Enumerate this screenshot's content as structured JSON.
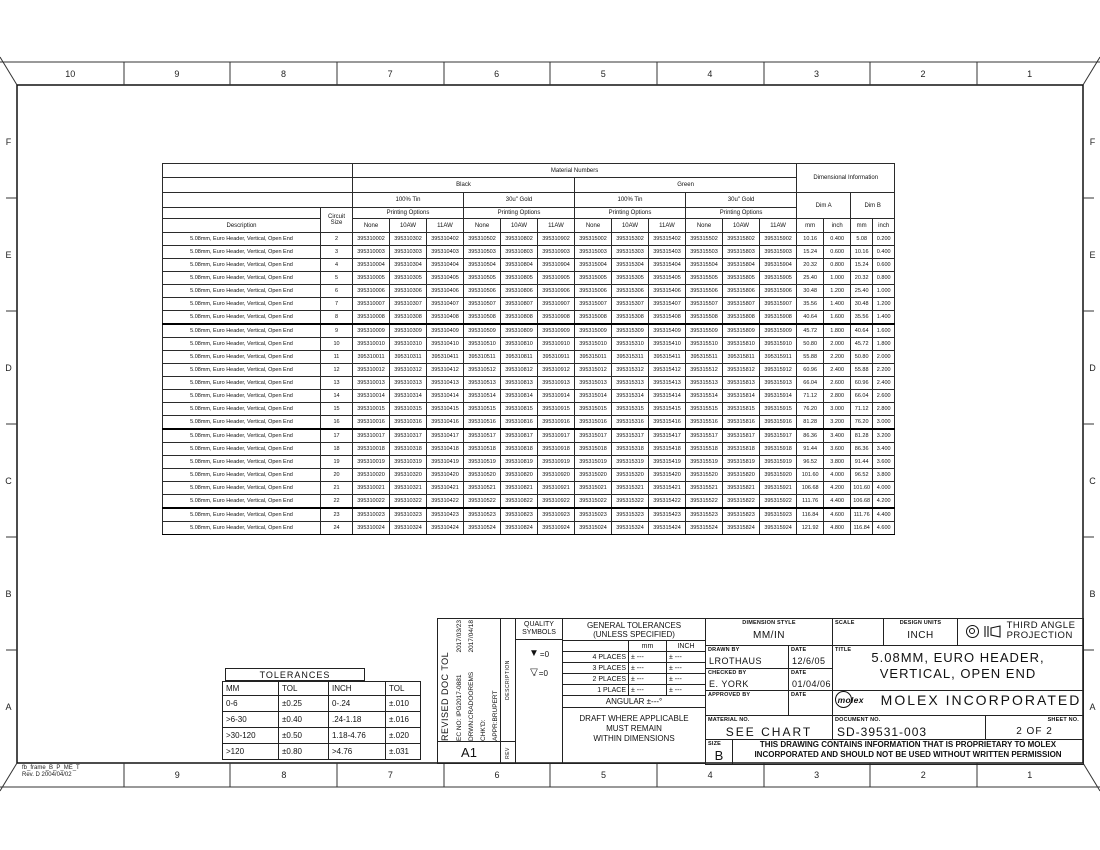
{
  "frame": {
    "top_zones": [
      "10",
      "9",
      "8",
      "7",
      "6",
      "5",
      "4",
      "3",
      "2",
      "1"
    ],
    "bottom_zones": [
      "9",
      "8",
      "7",
      "6",
      "5",
      "4",
      "3",
      "2",
      "1"
    ],
    "left_zones": [
      "F",
      "E",
      "D",
      "C",
      "B",
      "A"
    ],
    "right_zones": [
      "F",
      "E",
      "D",
      "C",
      "B",
      "A"
    ],
    "stamp_line1": "fb_frame_B_P_ME_T",
    "stamp_line2": "Rev. D 2004/04/02"
  },
  "chart": {
    "headers": {
      "material_numbers": "Material Numbers",
      "dimensional_information": "Dimensional Information",
      "black": "Black",
      "green": "Green",
      "tin": "100% Tin",
      "gold": "30u\" Gold",
      "plating_options": "Printing Options",
      "none": "None",
      "opt10": "10AW",
      "opt11": "11AW",
      "dim_a": "Dim A",
      "dim_b": "Dim B",
      "mm": "mm",
      "inch": "inch",
      "description": "Description",
      "circuit": "Circuit",
      "size": "Size"
    },
    "rows": [
      {
        "desc": "5.08mm, Euro Header, Vertical, Open End",
        "size": "2",
        "parts": [
          "395310002",
          "395310302",
          "395310402",
          "395310502",
          "395310802",
          "395310902",
          "395315002",
          "395315302",
          "395315402",
          "395315502",
          "395315802",
          "395315902"
        ],
        "dims": [
          "10.16",
          "0.400",
          "5.08",
          "0.200"
        ],
        "group_end": false
      },
      {
        "desc": "5.08mm, Euro Header, Vertical, Open End",
        "size": "3",
        "parts": [
          "395310003",
          "395310303",
          "395310403",
          "395310503",
          "395310803",
          "395310903",
          "395315003",
          "395315303",
          "395315403",
          "395315503",
          "395315803",
          "395315903"
        ],
        "dims": [
          "15.24",
          "0.600",
          "10.16",
          "0.400"
        ],
        "group_end": false
      },
      {
        "desc": "5.08mm, Euro Header, Vertical, Open End",
        "size": "4",
        "parts": [
          "395310004",
          "395310304",
          "395310404",
          "395310504",
          "395310804",
          "395310904",
          "395315004",
          "395315304",
          "395315404",
          "395315504",
          "395315804",
          "395315904"
        ],
        "dims": [
          "20.32",
          "0.800",
          "15.24",
          "0.600"
        ],
        "group_end": false
      },
      {
        "desc": "5.08mm, Euro Header, Vertical, Open End",
        "size": "5",
        "parts": [
          "395310005",
          "395310305",
          "395310405",
          "395310505",
          "395310805",
          "395310905",
          "395315005",
          "395315305",
          "395315405",
          "395315505",
          "395315805",
          "395315905"
        ],
        "dims": [
          "25.40",
          "1.000",
          "20.32",
          "0.800"
        ],
        "group_end": false
      },
      {
        "desc": "5.08mm, Euro Header, Vertical, Open End",
        "size": "6",
        "parts": [
          "395310006",
          "395310306",
          "395310406",
          "395310506",
          "395310806",
          "395310906",
          "395315006",
          "395315306",
          "395315406",
          "395315506",
          "395315806",
          "395315906"
        ],
        "dims": [
          "30.48",
          "1.200",
          "25.40",
          "1.000"
        ],
        "group_end": false
      },
      {
        "desc": "5.08mm, Euro Header, Vertical, Open End",
        "size": "7",
        "parts": [
          "395310007",
          "395310307",
          "395310407",
          "395310507",
          "395310807",
          "395310907",
          "395315007",
          "395315307",
          "395315407",
          "395315507",
          "395315807",
          "395315907"
        ],
        "dims": [
          "35.56",
          "1.400",
          "30.48",
          "1.200"
        ],
        "group_end": false
      },
      {
        "desc": "5.08mm, Euro Header, Vertical, Open End",
        "size": "8",
        "parts": [
          "395310008",
          "395310308",
          "395310408",
          "395310508",
          "395310808",
          "395310908",
          "395315008",
          "395315308",
          "395315408",
          "395315508",
          "395315808",
          "395315908"
        ],
        "dims": [
          "40.64",
          "1.600",
          "35.56",
          "1.400"
        ],
        "group_end": true
      },
      {
        "desc": "5.08mm, Euro Header, Vertical, Open End",
        "size": "9",
        "parts": [
          "395310009",
          "395310309",
          "395310409",
          "395310509",
          "395310809",
          "395310909",
          "395315009",
          "395315309",
          "395315409",
          "395315509",
          "395315809",
          "395315909"
        ],
        "dims": [
          "45.72",
          "1.800",
          "40.64",
          "1.600"
        ],
        "group_end": false
      },
      {
        "desc": "5.08mm, Euro Header, Vertical, Open End",
        "size": "10",
        "parts": [
          "395310010",
          "395310310",
          "395310410",
          "395310510",
          "395310810",
          "395310910",
          "395315010",
          "395315310",
          "395315410",
          "395315510",
          "395315810",
          "395315910"
        ],
        "dims": [
          "50.80",
          "2.000",
          "45.72",
          "1.800"
        ],
        "group_end": false
      },
      {
        "desc": "5.08mm, Euro Header, Vertical, Open End",
        "size": "11",
        "parts": [
          "395310011",
          "395310311",
          "395310411",
          "395310511",
          "395310811",
          "395310911",
          "395315011",
          "395315311",
          "395315411",
          "395315511",
          "395315811",
          "395315911"
        ],
        "dims": [
          "55.88",
          "2.200",
          "50.80",
          "2.000"
        ],
        "group_end": false
      },
      {
        "desc": "5.08mm, Euro Header, Vertical, Open End",
        "size": "12",
        "parts": [
          "395310012",
          "395310312",
          "395310412",
          "395310512",
          "395310812",
          "395310912",
          "395315012",
          "395315312",
          "395315412",
          "395315512",
          "395315812",
          "395315912"
        ],
        "dims": [
          "60.96",
          "2.400",
          "55.88",
          "2.200"
        ],
        "group_end": false
      },
      {
        "desc": "5.08mm, Euro Header, Vertical, Open End",
        "size": "13",
        "parts": [
          "395310013",
          "395310313",
          "395310413",
          "395310513",
          "395310813",
          "395310913",
          "395315013",
          "395315313",
          "395315413",
          "395315513",
          "395315813",
          "395315913"
        ],
        "dims": [
          "66.04",
          "2.600",
          "60.96",
          "2.400"
        ],
        "group_end": false
      },
      {
        "desc": "5.08mm, Euro Header, Vertical, Open End",
        "size": "14",
        "parts": [
          "395310014",
          "395310314",
          "395310414",
          "395310514",
          "395310814",
          "395310914",
          "395315014",
          "395315314",
          "395315414",
          "395315514",
          "395315814",
          "395315914"
        ],
        "dims": [
          "71.12",
          "2.800",
          "66.04",
          "2.600"
        ],
        "group_end": false
      },
      {
        "desc": "5.08mm, Euro Header, Vertical, Open End",
        "size": "15",
        "parts": [
          "395310015",
          "395310315",
          "395310415",
          "395310515",
          "395310815",
          "395310915",
          "395315015",
          "395315315",
          "395315415",
          "395315515",
          "395315815",
          "395315915"
        ],
        "dims": [
          "76.20",
          "3.000",
          "71.12",
          "2.800"
        ],
        "group_end": false
      },
      {
        "desc": "5.08mm, Euro Header, Vertical, Open End",
        "size": "16",
        "parts": [
          "395310016",
          "395310316",
          "395310416",
          "395310516",
          "395310816",
          "395310916",
          "395315016",
          "395315316",
          "395315416",
          "395315516",
          "395315816",
          "395315916"
        ],
        "dims": [
          "81.28",
          "3.200",
          "76.20",
          "3.000"
        ],
        "group_end": true
      },
      {
        "desc": "5.08mm, Euro Header, Vertical, Open End",
        "size": "17",
        "parts": [
          "395310017",
          "395310317",
          "395310417",
          "395310517",
          "395310817",
          "395310917",
          "395315017",
          "395315317",
          "395315417",
          "395315517",
          "395315817",
          "395315917"
        ],
        "dims": [
          "86.36",
          "3.400",
          "81.28",
          "3.200"
        ],
        "group_end": false
      },
      {
        "desc": "5.08mm, Euro Header, Vertical, Open End",
        "size": "18",
        "parts": [
          "395310018",
          "395310318",
          "395310418",
          "395310518",
          "395310818",
          "395310918",
          "395315018",
          "395315318",
          "395315418",
          "395315518",
          "395315818",
          "395315918"
        ],
        "dims": [
          "91.44",
          "3.600",
          "86.36",
          "3.400"
        ],
        "group_end": false
      },
      {
        "desc": "5.08mm, Euro Header, Vertical, Open End",
        "size": "19",
        "parts": [
          "395310019",
          "395310319",
          "395310419",
          "395310519",
          "395310819",
          "395310919",
          "395315019",
          "395315319",
          "395315419",
          "395315519",
          "395315819",
          "395315919"
        ],
        "dims": [
          "96.52",
          "3.800",
          "91.44",
          "3.600"
        ],
        "group_end": false
      },
      {
        "desc": "5.08mm, Euro Header, Vertical, Open End",
        "size": "20",
        "parts": [
          "395310020",
          "395310320",
          "395310420",
          "395310520",
          "395310820",
          "395310920",
          "395315020",
          "395315320",
          "395315420",
          "395315520",
          "395315820",
          "395315920"
        ],
        "dims": [
          "101.60",
          "4.000",
          "96.52",
          "3.800"
        ],
        "group_end": false
      },
      {
        "desc": "5.08mm, Euro Header, Vertical, Open End",
        "size": "21",
        "parts": [
          "395310021",
          "395310321",
          "395310421",
          "395310521",
          "395310821",
          "395310921",
          "395315021",
          "395315321",
          "395315421",
          "395315521",
          "395315821",
          "395315921"
        ],
        "dims": [
          "106.68",
          "4.200",
          "101.60",
          "4.000"
        ],
        "group_end": false
      },
      {
        "desc": "5.08mm, Euro Header, Vertical, Open End",
        "size": "22",
        "parts": [
          "395310022",
          "395310322",
          "395310422",
          "395310522",
          "395310822",
          "395310922",
          "395315022",
          "395315322",
          "395315422",
          "395315522",
          "395315822",
          "395315922"
        ],
        "dims": [
          "111.76",
          "4.400",
          "106.68",
          "4.200"
        ],
        "group_end": true
      },
      {
        "desc": "5.08mm, Euro Header, Vertical, Open End",
        "size": "23",
        "parts": [
          "395310023",
          "395310323",
          "395310423",
          "395310523",
          "395310823",
          "395310923",
          "395315023",
          "395315323",
          "395315423",
          "395315523",
          "395315823",
          "395315923"
        ],
        "dims": [
          "116.84",
          "4.600",
          "111.76",
          "4.400"
        ],
        "group_end": false
      },
      {
        "desc": "5.08mm, Euro Header, Vertical, Open End",
        "size": "24",
        "parts": [
          "395310024",
          "395310324",
          "395310424",
          "395310524",
          "395310824",
          "395310924",
          "395315024",
          "395315324",
          "395315424",
          "395315524",
          "395315824",
          "395315924"
        ],
        "dims": [
          "121.92",
          "4.800",
          "116.84",
          "4.600"
        ],
        "group_end": false
      }
    ]
  },
  "tolerances": {
    "title": "TOLERANCES",
    "headers": [
      "MM",
      "TOL",
      "INCH",
      "TOL"
    ],
    "rows": [
      {
        "c": [
          "0-6",
          "±0.25",
          "0-.24",
          "±.010"
        ]
      },
      {
        "c": [
          ">6-30",
          "±0.40",
          ".24-1.18",
          "±.016"
        ]
      },
      {
        "c": [
          ">30-120",
          "±0.50",
          "1.18-4.76",
          "±.020"
        ]
      },
      {
        "c": [
          ">120",
          "±0.80",
          ">4.76",
          "±.031"
        ]
      }
    ]
  },
  "revision": {
    "desc": "REVISED DOC TOL",
    "ec": "EC NO: IPG2017-0881",
    "ec_date": "2017/03/23",
    "drwn": "DRWN:CRADOOREMS",
    "drwn_date": "2017/04/18",
    "chkd": "CHK'D:",
    "appr": "APPR:BRUPERT",
    "rev": "A1",
    "description_label": "DESCRIPTION",
    "rev_label": "REV"
  },
  "quality": {
    "title1": "QUALITY",
    "title2": "SYMBOLS",
    "sym1_eq": "=0",
    "sym2_eq": "=0"
  },
  "general_tolerances": {
    "title1": "GENERAL TOLERANCES",
    "title2": "(UNLESS SPECIFIED)",
    "col_mm": "mm",
    "col_inch": "INCH",
    "rows": [
      {
        "label": "4 PLACES",
        "mm": "± ---",
        "inch": "± ---"
      },
      {
        "label": "3 PLACES",
        "mm": "± ---",
        "inch": "± ---"
      },
      {
        "label": "2 PLACES",
        "mm": "± ---",
        "inch": "± ---"
      },
      {
        "label": "1 PLACE",
        "mm": "± ---",
        "inch": "± ---"
      }
    ],
    "angular": "ANGULAR  ±---°",
    "note1": "DRAFT WHERE APPLICABLE",
    "note2": "MUST REMAIN",
    "note3": "WITHIN DIMENSIONS"
  },
  "title_block": {
    "dimension_style_label": "DIMENSION STYLE",
    "dimension_style": "MM/IN",
    "scale_label": "SCALE",
    "scale": "",
    "design_units_label": "DESIGN UNITS",
    "design_units": "INCH",
    "projection_line1": "THIRD ANGLE",
    "projection_line2": "PROJECTION",
    "drawn_by_label": "DRAWN BY",
    "date_label": "DATE",
    "drawn_by": "LROTHAUS",
    "drawn_date": "12/6/05",
    "checked_by_label": "CHECKED BY",
    "checked_by": "E. YORK",
    "checked_date": "01/04/06",
    "approved_by_label": "APPROVED BY",
    "approved_by": "",
    "approved_date": "",
    "title_label": "TITLE",
    "title_line1": "5.08MM, EURO HEADER,",
    "title_line2": "VERTICAL, OPEN END",
    "logo_text": "molex",
    "company": "MOLEX INCORPORATED",
    "material_no_label": "MATERIAL NO.",
    "material_no": "SEE CHART",
    "document_no_label": "DOCUMENT NO.",
    "document_no": "SD-39531-003",
    "sheet_no_label": "SHEET NO.",
    "sheet_no": "2 OF 2",
    "size_label": "SIZE",
    "size": "B",
    "proprietary_line1": "THIS DRAWING CONTAINS INFORMATION THAT IS PROPRIETARY TO MOLEX",
    "proprietary_line2": "INCORPORATED AND SHOULD NOT BE USED WITHOUT WRITTEN PERMISSION"
  }
}
